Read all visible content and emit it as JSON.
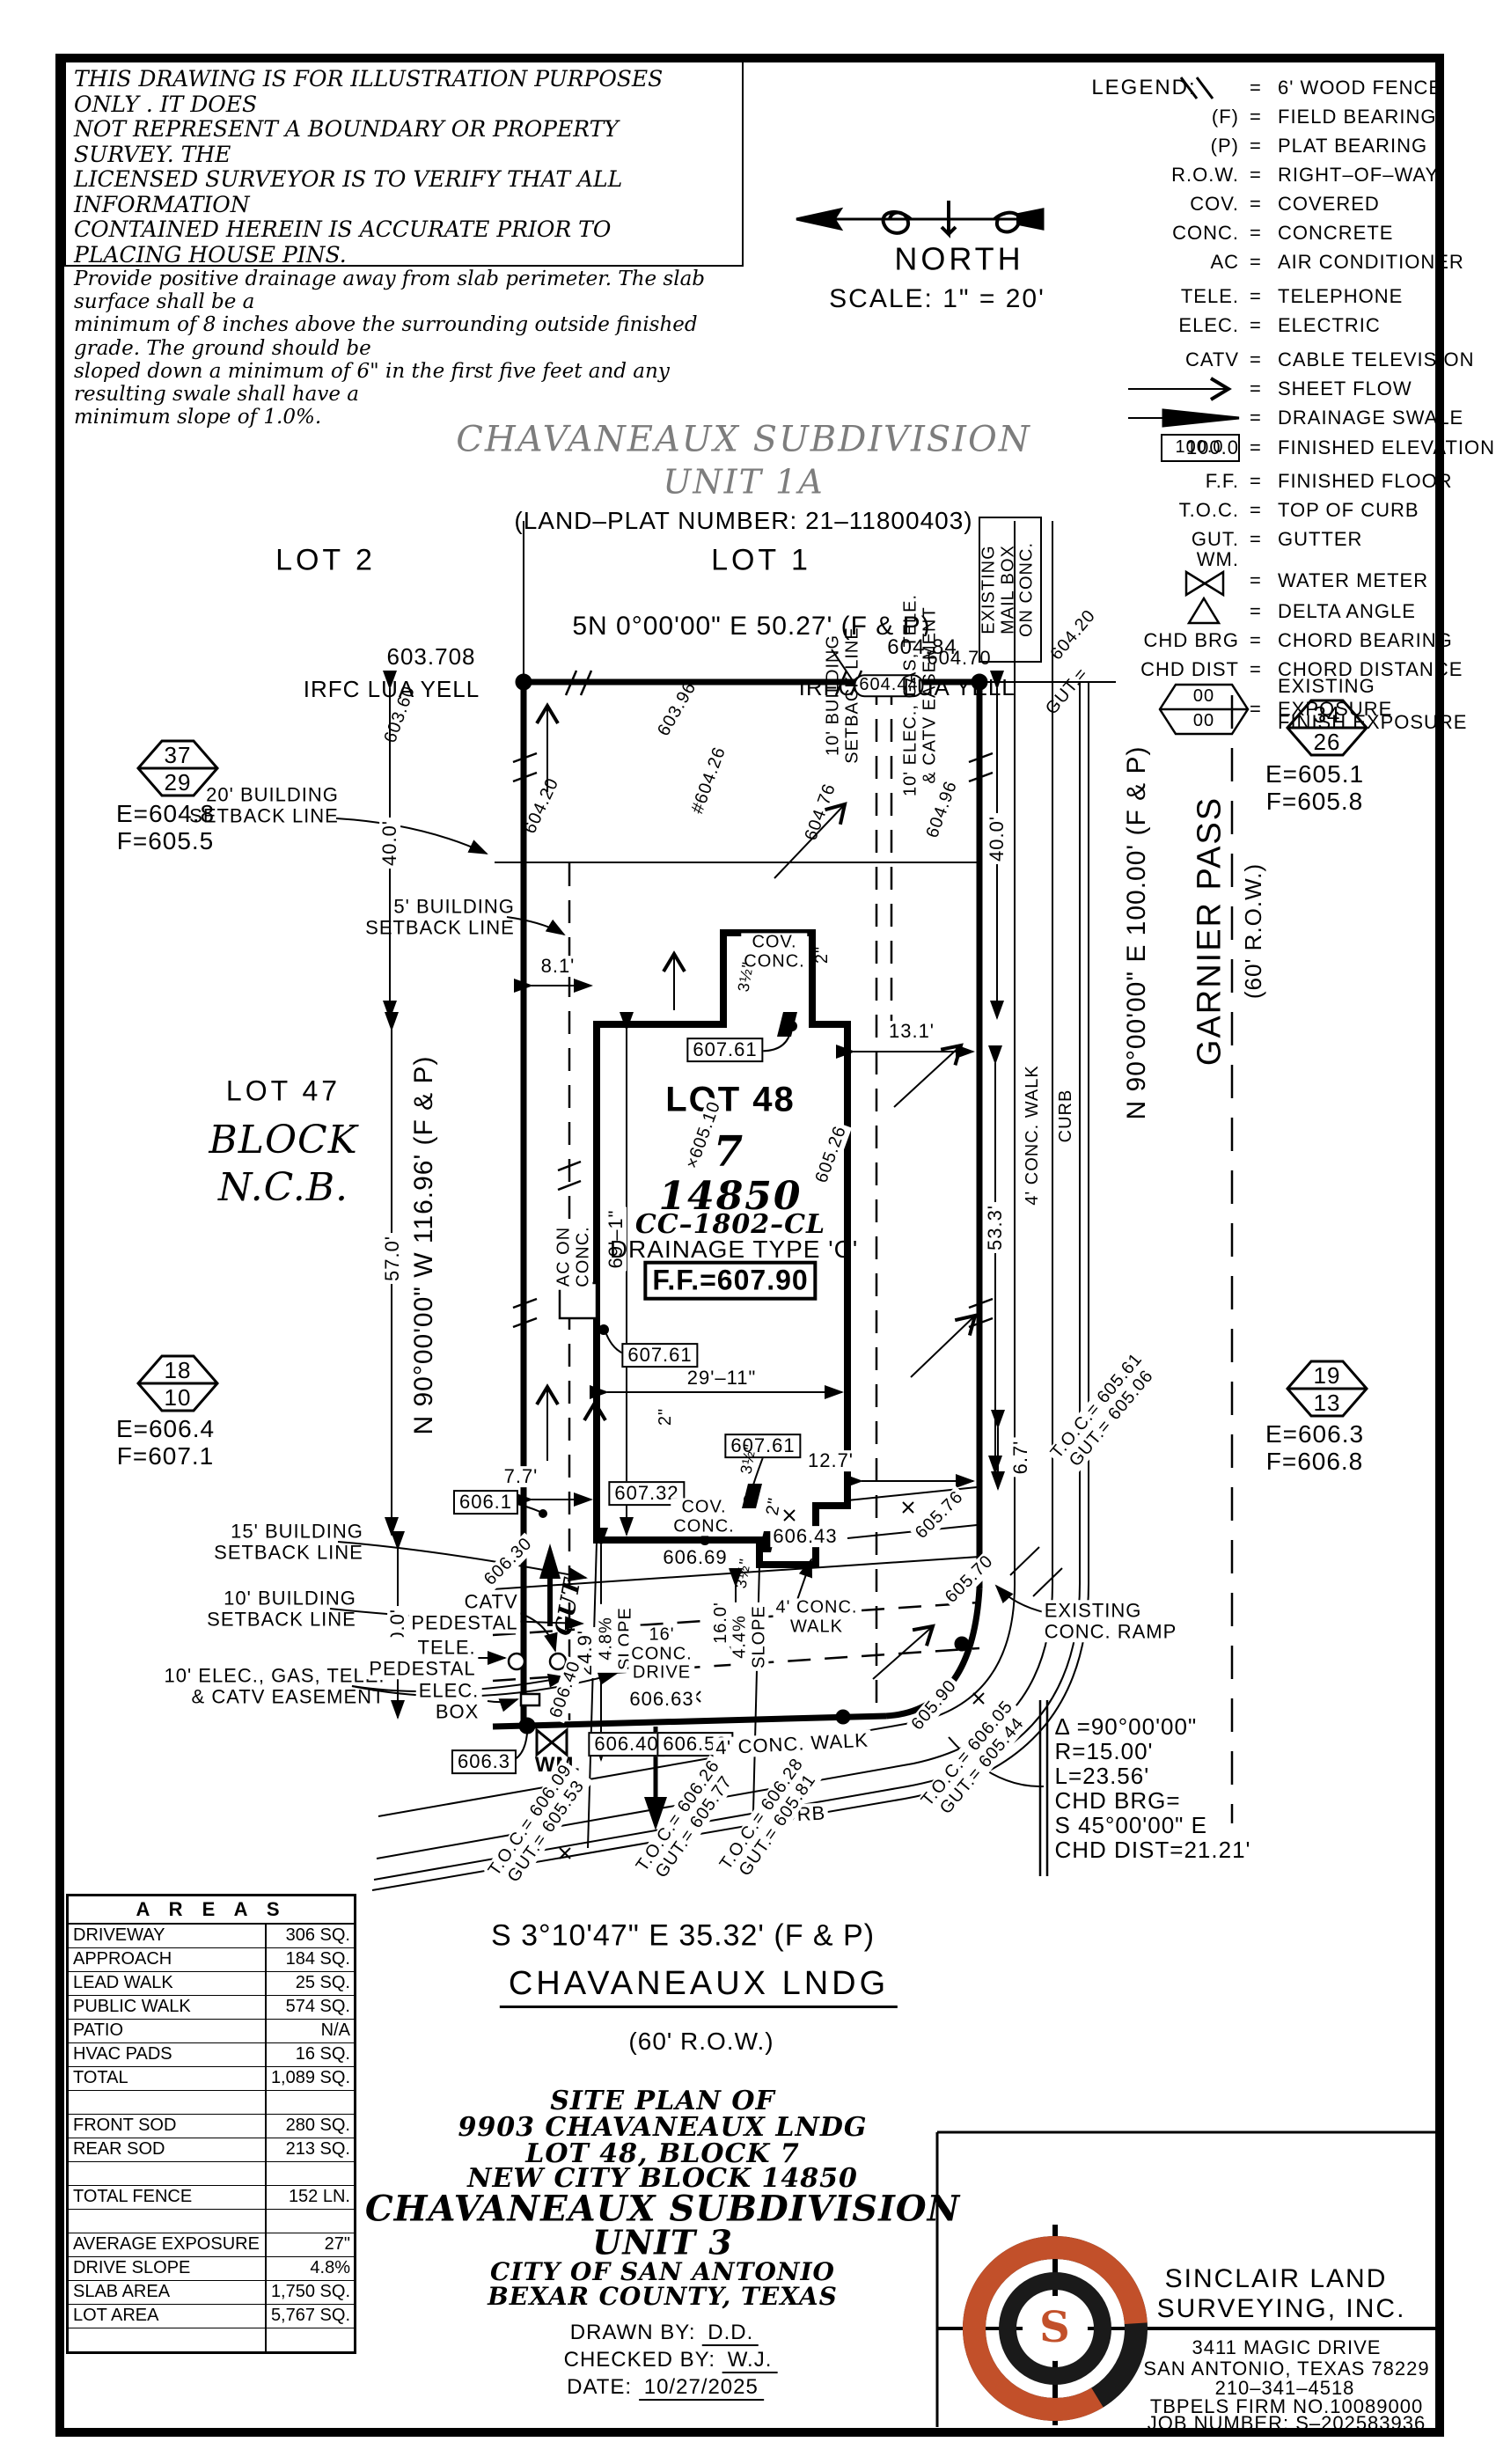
{
  "disclaimer": {
    "lines": [
      "THIS DRAWING IS FOR ILLUSTRATION PURPOSES ONLY . IT DOES",
      "NOT REPRESENT A BOUNDARY OR PROPERTY SURVEY. THE",
      "LICENSED SURVEYOR IS TO VERIFY THAT ALL INFORMATION",
      "CONTAINED HEREIN IS ACCURATE PRIOR TO PLACING HOUSE PINS.",
      "Provide positive drainage away from slab perimeter. The slab surface shall be a",
      "minimum of 8 inches above the surrounding outside finished grade. The ground should be",
      "sloped down a minimum of 6\" in the first five feet and any resulting swale shall have a",
      "minimum slope of 1.0%."
    ]
  },
  "north": {
    "label": "NORTH",
    "scale": "SCALE:  1\" = 20'"
  },
  "legend": {
    "title": "LEGEND:",
    "rows": [
      {
        "abbr": "",
        "eq": "=",
        "desc": "6' WOOD FENCE"
      },
      {
        "abbr": "(F)",
        "eq": "=",
        "desc": "FIELD BEARING"
      },
      {
        "abbr": "(P)",
        "eq": "=",
        "desc": "PLAT BEARING"
      },
      {
        "abbr": "R.O.W.",
        "eq": "=",
        "desc": "RIGHT–OF–WAY"
      },
      {
        "abbr": "COV.",
        "eq": "=",
        "desc": "COVERED"
      },
      {
        "abbr": "CONC.",
        "eq": "=",
        "desc": "CONCRETE"
      },
      {
        "abbr": "AC",
        "eq": "=",
        "desc": "AIR CONDITIONER"
      },
      {
        "abbr": "TELE.",
        "eq": "=",
        "desc": "TELEPHONE"
      },
      {
        "abbr": "ELEC.",
        "eq": "=",
        "desc": "ELECTRIC"
      },
      {
        "abbr": "CATV",
        "eq": "=",
        "desc": "CABLE TELEVISION"
      },
      {
        "abbr": "",
        "eq": "=",
        "desc": "SHEET FLOW"
      },
      {
        "abbr": "",
        "eq": "=",
        "desc": "DRAINAGE SWALE"
      },
      {
        "abbr": "100.0",
        "eq": "=",
        "desc": "FINISHED ELEVATION"
      },
      {
        "abbr": "F.F.",
        "eq": "=",
        "desc": "FINISHED FLOOR"
      },
      {
        "abbr": "T.O.C.",
        "eq": "=",
        "desc": "TOP OF CURB"
      },
      {
        "abbr": "GUT.",
        "eq": "=",
        "desc": "GUTTER"
      },
      {
        "abbr": "WM.",
        "eq": "=",
        "desc": "WATER METER"
      },
      {
        "abbr": "",
        "eq": "=",
        "desc": "DELTA ANGLE"
      },
      {
        "abbr": "CHD BRG",
        "eq": "=",
        "desc": "CHORD BEARING"
      },
      {
        "abbr": "CHD DIST",
        "eq": "=",
        "desc": "CHORD DISTANCE"
      },
      {
        "abbr": "",
        "eq": "=",
        "desc": "EXISTING EXPOSURE",
        "desc2": "FINISH EXPOSURE",
        "hex_top": "00",
        "hex_bot": "00"
      }
    ]
  },
  "header": {
    "subdivision": "CHAVANEAUX SUBDIVISION",
    "unit": "UNIT 1A",
    "plat": "(LAND–PLAT NUMBER: 21–11800403)"
  },
  "plan": {
    "lot2": "LOT 2",
    "lot1": "LOT 1",
    "lot47": "LOT 47",
    "block": "BLOCK",
    "ncb": "N.C.B.",
    "brg_north": "5N 0°00'00\" E 50.27' (F & P)",
    "el_603708": "603.708",
    "irfc_left": "IRFC LUA YELL",
    "el_60484": "604.84",
    "el_60470": "604.70",
    "irfc_r1": "IRFC",
    "el_60444": "604.44",
    "irfc_r2": "LUA YELL",
    "el_60360": "603.60",
    "el_60396": "603.96",
    "el_60426": "#604.26",
    "el_60420w": "604.20",
    "el_60476": "604.76",
    "el_60496": "604.96",
    "el_60420e": "604.20",
    "gut_e": "GUT.=",
    "mailbox1": "EXISTING",
    "mailbox2": "MAIL BOX",
    "mailbox3": "ON CONC.",
    "bsl20_1": "20' BUILDING",
    "bsl20_2": "SETBACK LINE",
    "bsl5_1": "5' BUILDING",
    "bsl5_2": "SETBACK LINE",
    "bsl10r_1": "10' BUILDING",
    "bsl10r_2": "SETBACK LINE",
    "easr_1": "10' ELEC., GAS, TELE.",
    "easr_2": "& CATV EASEMENT",
    "dim40l": "40.0'",
    "dim40r": "40.0'",
    "dim81": "8.1'",
    "dim131": "13.1'",
    "hex37": "37",
    "hex29": "29",
    "hex37e": "E=604.8",
    "hex37f": "F=605.5",
    "hex34": "34",
    "hex26": "26",
    "hex34e": "E=605.1",
    "hex34f": "F=605.8",
    "hex18": "18",
    "hex10": "10",
    "hex18e": "E=606.4",
    "hex18f": "F=607.1",
    "hex19": "19",
    "hex13": "13",
    "hex19e": "E=606.3",
    "hex19f": "F=606.8",
    "brg_west": "N 90°00'00\" W 116.96' (F & P)",
    "dim570": "57.0'",
    "brg_east": "N 90°00'00\" E 100.00' (F & P)",
    "garnier": "GARNIER PASS",
    "garnier_row": "(60' R.O.W.)",
    "walk_r": "4' CONC. WALK",
    "curb_r": "CURB",
    "dim533": "53.3'",
    "lot48": "LOT 48",
    "lot48_no": "7",
    "ncb_no": "14850",
    "plan_no": "CC–1802–CL",
    "drainage": "DRAINAGE TYPE 'C'",
    "ff": "F.F.=607.90",
    "el_60761a": "607.61",
    "el_60761b": "607.61",
    "el_60761c": "607.61",
    "el_60732": "607.32",
    "el_60669": "606.69",
    "el_60643": "606.43",
    "el_60510": "×605.10",
    "el_60526": "605.26",
    "el_60547": "605.47",
    "el_60514": "×605.14",
    "cov_t1": "COV.",
    "cov_t2": "CONC.",
    "cov_b1": "COV.",
    "cov_b2": "CONC.",
    "dim691": "69'–1\"",
    "dim2911": "29'–11\"",
    "in2a": "2\"",
    "in2b": "2\"",
    "in2c": "2\"",
    "in35a": "3½\"",
    "in35b": "3½\"",
    "in35c": "3½\"",
    "ac1": "AC ON",
    "ac2": "CONC.",
    "dim127": "12.7'",
    "dim67": "6.7'",
    "el_60576": "605.76",
    "el_60570": "605.70",
    "bsl15_1": "15' BUILDING",
    "bsl15_2": "SETBACK LINE",
    "bsl10b_1": "10' BUILDING",
    "bsl10b_2": "SETBACK LINE",
    "easb_1": "10' ELEC., GAS, TELE.",
    "easb_2": "& CATV EASEMENT",
    "dim200": "20.0'",
    "dim249": "24.9'",
    "dim160": "16.0'",
    "dim77": "7.7'",
    "el_6061": "606.1",
    "el_60630": "606.30",
    "el_60640d": "606.40",
    "cut": "CUT",
    "catv1": "CATV",
    "catv2": "PEDESTAL",
    "tele1": "TELE.",
    "tele2": "PEDESTAL",
    "elec1": "ELEC.",
    "elec2": "BOX",
    "slope48a": "4.8%",
    "slope48b": "SLOPE",
    "slope44a": "4.4%",
    "slope44b": "SLOPE",
    "drive1": "16'",
    "drive2": "CONC.",
    "drive3": "DRIVE",
    "walk_up1": "4' CONC.",
    "walk_up2": "WALK",
    "walk_low": "4' CONC. WALK",
    "curb_low": "CURB",
    "el_60663": "606.63",
    "el_60640bx": "606.40",
    "el_60652": "606.52",
    "wm": "WM.",
    "el_6063": "606.3",
    "toc_b1_1": "T.O.C.= 606.09",
    "toc_b1_2": "GUT.= 605.53",
    "toc_b2_1": "T.O.C.= 606.26",
    "toc_b2_2": "GUT.= 605.77",
    "toc_b3_1": "T.O.C.= 606.28",
    "toc_b3_2": "GUT.= 605.81",
    "toc_r1_1": "T.O.C.= 605.61",
    "toc_r1_2": "GUT.= 605.06",
    "toc_r2_1": "T.O.C.= 606.05",
    "toc_r2_2": "GUT.= 605.44",
    "el_60590": "605.90",
    "ramp1": "EXISTING",
    "ramp2": "CONC. RAMP",
    "street_brg": "S 3°10'47\" E 35.32' (F & P)",
    "street_name": "CHAVANEAUX LNDG",
    "street_row": "(60' R.O.W.)"
  },
  "curve": {
    "delta": "Δ =90°00'00\"",
    "radius": "R=15.00'",
    "length": "L=23.56'",
    "chd_brg_label": "CHD BRG=",
    "chd_brg": "S 45°00'00\" E",
    "chd_dist": "CHD DIST=21.21'"
  },
  "areas": {
    "title": "A R E A S",
    "rows": [
      {
        "label": "DRIVEWAY",
        "value": "306 SQ. FT."
      },
      {
        "label": "APPROACH",
        "value": "184 SQ. FT."
      },
      {
        "label": "LEAD WALK",
        "value": "25 SQ. FT."
      },
      {
        "label": "PUBLIC WALK",
        "value": "574 SQ. FT."
      },
      {
        "label": "PATIO",
        "value": "N/A"
      },
      {
        "label": "HVAC PADS",
        "value": "16 SQ. FT."
      },
      {
        "label": "TOTAL",
        "value": "1,089 SQ. FT."
      },
      {
        "label": "",
        "value": ""
      },
      {
        "label": "FRONT SOD",
        "value": "280 SQ. YD."
      },
      {
        "label": "REAR SOD",
        "value": "213 SQ. YD."
      },
      {
        "label": "",
        "value": ""
      },
      {
        "label": "TOTAL FENCE",
        "value": "152 LN. FT."
      },
      {
        "label": "",
        "value": ""
      },
      {
        "label": "AVERAGE EXPOSURE",
        "value": "27\""
      },
      {
        "label": "DRIVE SLOPE",
        "value": "4.8%"
      },
      {
        "label": "SLAB AREA",
        "value": "1,750 SQ. FT."
      },
      {
        "label": "LOT AREA",
        "value": "5,767 SQ. FT."
      },
      {
        "label": "",
        "value": ""
      }
    ]
  },
  "titleblock": {
    "l1": "SITE PLAN OF",
    "l2": "9903 CHAVANEAUX LNDG",
    "l3": "LOT 48, BLOCK 7",
    "l4": "NEW CITY BLOCK 14850",
    "l5": "CHAVANEAUX SUBDIVISION",
    "l6": "UNIT 3",
    "l7": "CITY OF SAN ANTONIO",
    "l8": "BEXAR COUNTY, TEXAS",
    "drawn_label": "DRAWN BY:",
    "drawn_value": "D.D.",
    "checked_label": "CHECKED BY:",
    "checked_value": "W.J.",
    "date_label": "DATE:",
    "date_value": "10/27/2025"
  },
  "surveyor": {
    "logo_s": "S",
    "name1": "SINCLAIR LAND",
    "name2": "SURVEYING, INC.",
    "addr": "3411 MAGIC DRIVE",
    "city": "SAN ANTONIO, TEXAS 78229",
    "phone": "210–341–4518",
    "firm": "TBPELS FIRM NO.10089000",
    "job": "JOB NUMBER: S–202583936"
  },
  "colors": {
    "accent_orange": "#c2502a",
    "title_gray": "#7d7d7d"
  }
}
